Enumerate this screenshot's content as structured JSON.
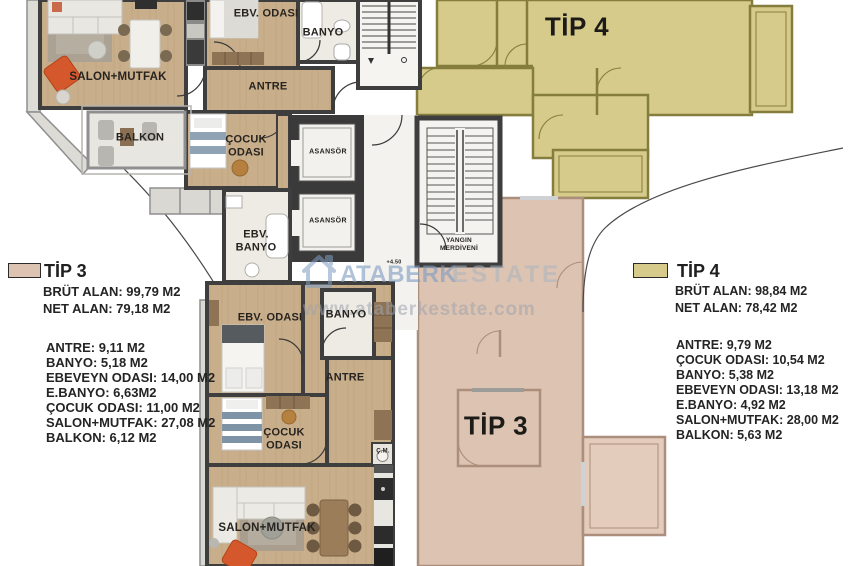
{
  "watermark": {
    "brand_left": "ATABERK",
    "brand_right": "ESTATE",
    "url": "www.ataberkestate.com"
  },
  "units": {
    "tip4_plan_label": "TİP 4",
    "tip3_plan_label": "TİP 3"
  },
  "rooms": {
    "top_apartment": {
      "salon": "SALON+MUTFAK",
      "master": "EBV. ODASI",
      "bath": "BANYO",
      "hall": "ANTRE",
      "balcony": "BALKON",
      "kids": "ÇOCUK ODASI"
    },
    "core": {
      "elevator": "ASANSÖR",
      "master_bath": "EBV. BANYO",
      "fire_stairs": "YANGIN MERDİVENİ",
      "level_mark": "+4.50"
    },
    "bottom_apartment": {
      "master": "EBV. ODASI",
      "bath": "BANYO",
      "hall": "ANTRE",
      "kids": "ÇOCUK ODASI",
      "washer": "Ç.M.",
      "salon": "SALON+MUTFAK"
    }
  },
  "legend_tip3": {
    "title": "TİP 3",
    "gross": "BRÜT ALAN: 99,79 M2",
    "net": "NET ALAN: 79,18 M2",
    "items": [
      "ANTRE: 9,11 M2",
      "BANYO: 5,18 M2",
      "EBEVEYN ODASI: 14,00 M2",
      "E.BANYO: 6,63M2",
      "ÇOCUK ODASI: 11,00 M2",
      "SALON+MUTFAK: 27,08 M2",
      "BALKON: 6,12 M2"
    ]
  },
  "legend_tip4": {
    "title": "TİP 4",
    "gross": "BRÜT ALAN: 98,84 M2",
    "net": "NET ALAN: 78,42 M2",
    "items": [
      "ANTRE: 9,79 M2",
      "ÇOCUK ODASI: 10,54 M2",
      "BANYO: 5,38 M2",
      "EBEVEYN ODASI: 13,18 M2",
      "E.BANYO: 4,92 M2",
      "SALON+MUTFAK: 28,00 M2",
      "BALKON: 5,63 M2"
    ]
  },
  "colors": {
    "tip3_fill": "#ddc3b1",
    "tip4_fill": "#d6cb8a",
    "wall_dark": "#3e3e3e",
    "wood_floor": "#c9ae8b",
    "watermark_blue": "#7e9cc1"
  }
}
